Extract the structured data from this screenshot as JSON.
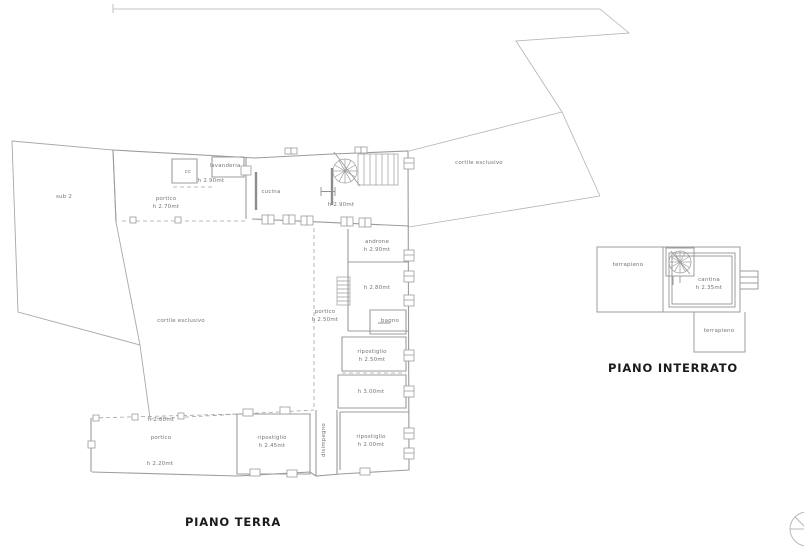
{
  "drawing": {
    "background": "#ffffff",
    "line_color": "#9c9c9c",
    "label_color": "#767676",
    "title_color": "#1b1b1b"
  },
  "ground_floor": {
    "title": "PIANO TERRA",
    "labels": {
      "sub2": "sub 2",
      "portico_top": "portico",
      "portico_top_h": "h 2.70mt",
      "cc": "cc",
      "lavanderia": "lavanderia",
      "lavanderia_h": "h 2.90mt",
      "cucina": "cucina",
      "soggiorno_h": "h 2.90mt",
      "androne": "androne",
      "androne_h": "h 2.90mt",
      "stanza_h": "h 2.80mt",
      "portico_scala": "portico",
      "portico_scala_h": "h 2.50mt",
      "bagno": "bagno",
      "ripostiglio1": "ripostiglio",
      "ripostiglio1_h": "h 2.50mt",
      "stanza2_h": "h 3.00mt",
      "cortile": "cortile esclusivo",
      "cortile_ne": "cortile esclusivo",
      "portico_sw_h_top": "h 2.80mt",
      "portico_sw": "portico",
      "portico_sw_h": "h 2.20mt",
      "ripostiglio2": "ripostiglio",
      "ripostiglio2_h": "h 2.45mt",
      "disimpegno": "disimpegno",
      "ripostiglio3": "ripostiglio",
      "ripostiglio3_h": "h 2.00mt"
    }
  },
  "basement": {
    "title": "PIANO INTERRATO",
    "labels": {
      "terrapieno_left": "terrapieno",
      "cantina": "cantina",
      "cantina_h": "h 2.35mt",
      "terrapieno_bottom": "terrapieno"
    }
  }
}
